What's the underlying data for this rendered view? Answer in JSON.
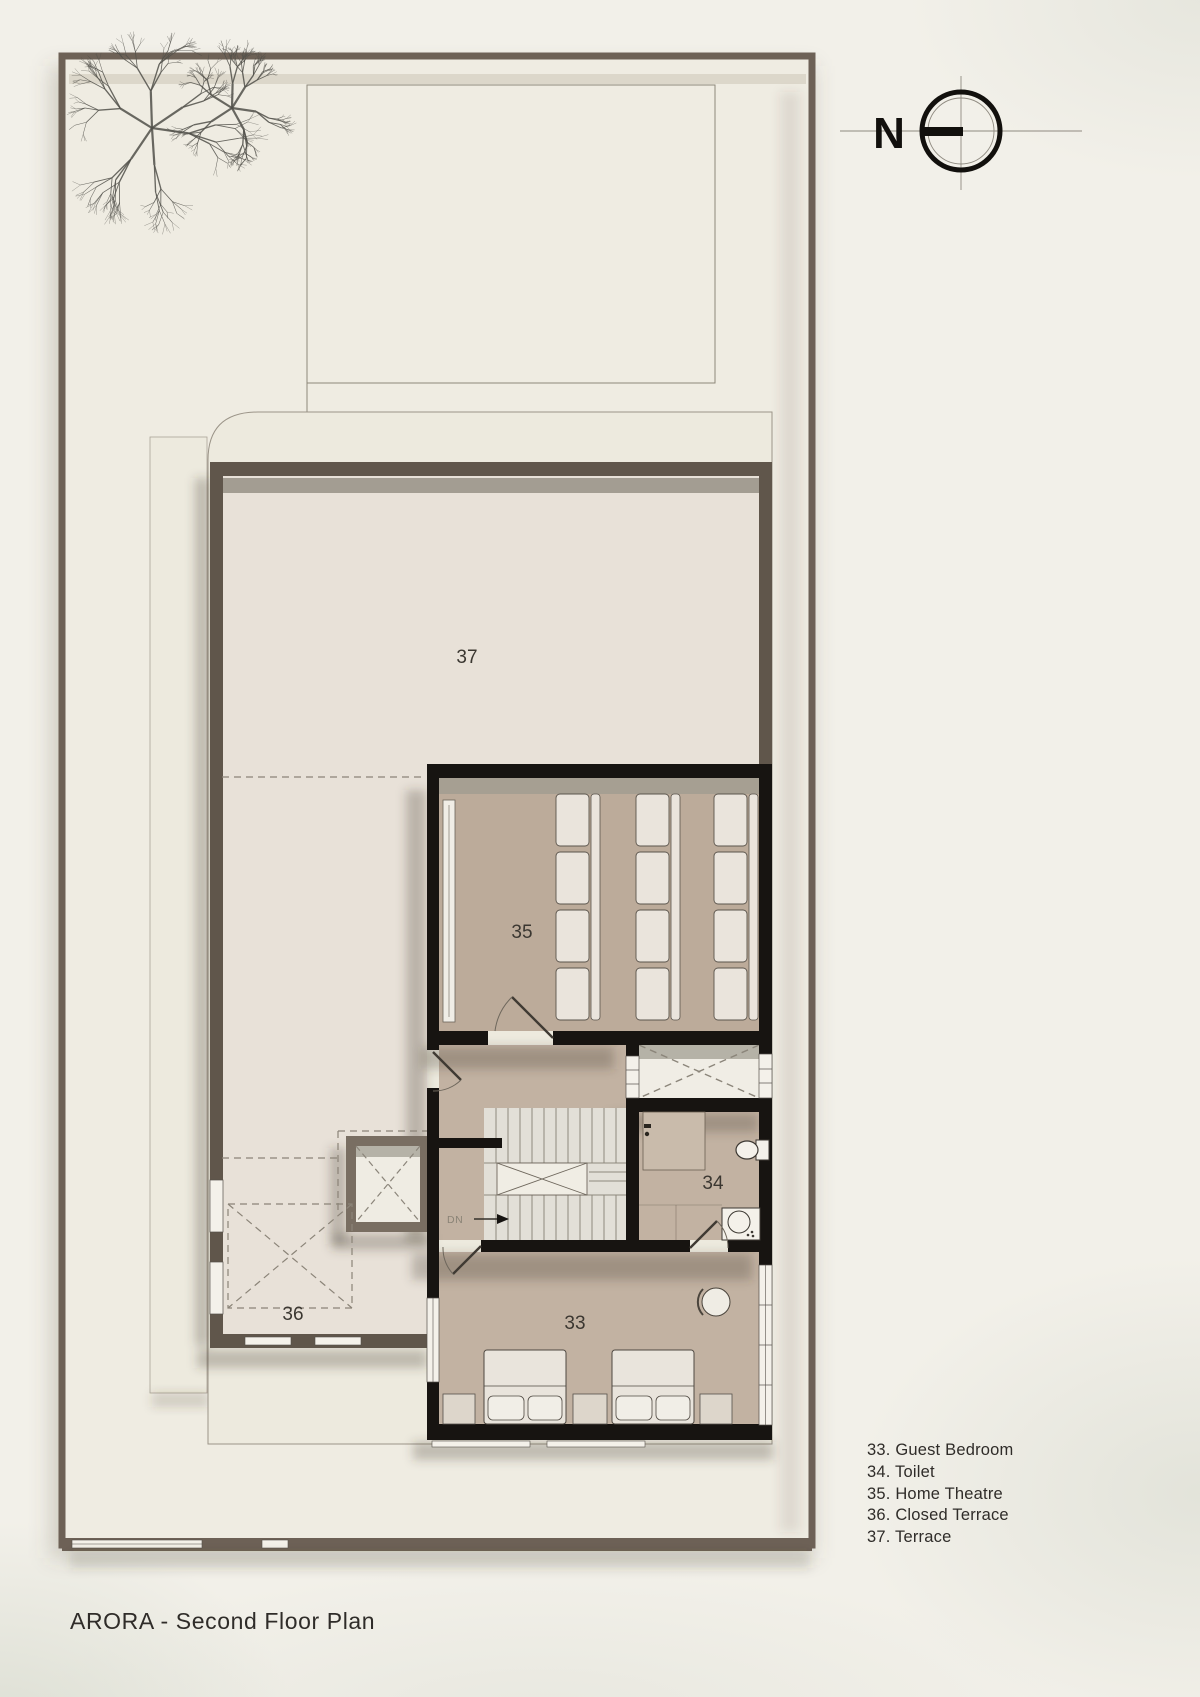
{
  "page": {
    "title": "ARORA - Second Floor Plan"
  },
  "compass": {
    "label": "N"
  },
  "plan": {
    "rooms": {
      "guest_bedroom": {
        "number": "33"
      },
      "toilet": {
        "number": "34"
      },
      "home_theatre": {
        "number": "35"
      },
      "closed_terrace": {
        "number": "36"
      },
      "terrace": {
        "number": "37"
      }
    },
    "stairs": {
      "direction_label": "DN"
    }
  },
  "legend": {
    "items": [
      {
        "text": "33. Guest Bedroom"
      },
      {
        "text": "34. Toilet"
      },
      {
        "text": "35. Home Theatre"
      },
      {
        "text": "36. Closed Terrace"
      },
      {
        "text": "37. Terrace"
      }
    ]
  },
  "colors": {
    "paper": "#f2f0e9",
    "site_fill": "#efece2",
    "boundary_brown": "#6d6156",
    "wall_brown": "#60564b",
    "wall_black": "#171411",
    "terrace_fill": "#e8e1d8",
    "theatre_fill": "#bcab9a",
    "room_fill": "#c2b2a2",
    "furniture_fill": "#eae5dd",
    "text": "#2f2c29"
  }
}
